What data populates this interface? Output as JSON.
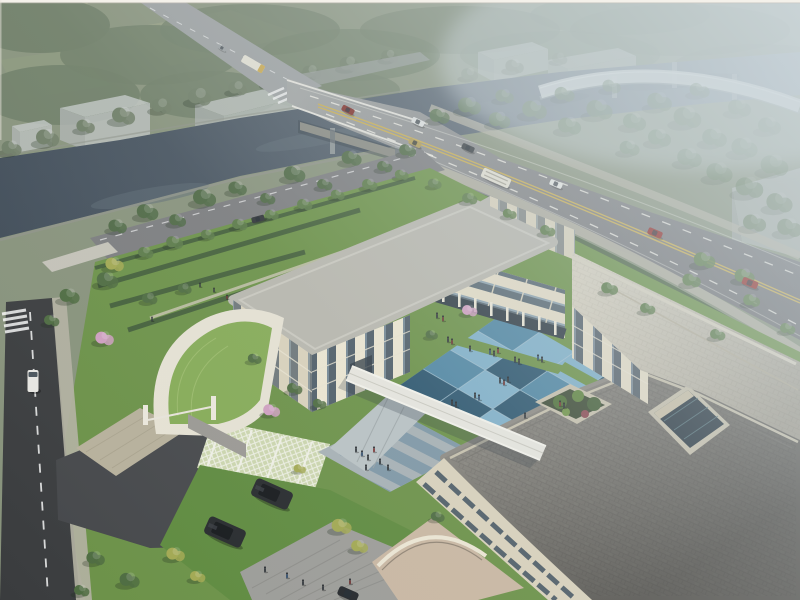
{
  "image": {
    "kind": "architectural aerial rendering",
    "subject": "Aerial view of a three-storey cream building complex with a blue checkered courtyard, entrance gatehouse with green roof, grass-grid parking, riverside arterial road with bridge and a curved highway overpass in haze",
    "no_text_visible": true
  },
  "inventory": {
    "buildings": [
      "west-wing",
      "north-range",
      "east-wing",
      "south-building",
      "gatehouse",
      "warehouses-distant"
    ],
    "vehicles": {
      "road_cars": 8,
      "buses": 2,
      "parked_suvs": 2,
      "white_van": 1,
      "local_road_car": 1,
      "bottom_edge_car": 1
    },
    "people_approx": 38,
    "blossom_trees": 3,
    "courtyard_tiles": "checkered blue plaza 4x4",
    "water": "canal river crossing under road bridge and overpass"
  },
  "colors": {
    "fog": "#ccd5d8",
    "forest_far": "#6e7d66",
    "forest_near": "#55704a",
    "tree_green": "#5b7a48",
    "tree_dark": "#46613c",
    "tree_yellow": "#a2a851",
    "blossom": "#cf9fc0",
    "hedge": "#3f5a38",
    "lawn": "#6b9147",
    "lawn_dark": "#5e8a3e",
    "grass_roof": "#85ab56",
    "river": "#46525e",
    "bank_wall": "#8e9288",
    "road_far": "#9b9fa0",
    "road_dark": "#3a3c3e",
    "asphalt_drive": "#45474a",
    "lane_white": "#eceae2",
    "lane_yellow": "#c9ad4e",
    "sidewalk": "#b4b1a2",
    "bridge_girder": "#cfc8b2",
    "overpass": "#d3d8d5",
    "wall_lit": "#ece6d2",
    "wall_shaded": "#d9d2bc",
    "wall_warm": "#e3dcc6",
    "roof_light": "#b8b7ae",
    "roof_tile": "#8d8a83",
    "parapet": "#c6c0ac",
    "glass_dark": "#3e4e5c",
    "glass_atrium": "#2c3a44",
    "court_light": "#7fb0c9",
    "court_mid": "#4f86a3",
    "court_dark": "#2b556e",
    "court_joint": "#a5c2d1",
    "walkway": "#e7e6df",
    "stripe_blue": "#7e97a6",
    "stripe_gray": "#a7b1b5",
    "plaza": "#9c9c98",
    "terrace": "#c9b7a2",
    "paver_lattice": "#ccd6ae",
    "suv": "#26292c",
    "car_red": "#8e2420",
    "car_white": "#e7e8e4",
    "car_gold": "#b09a52",
    "car_dark": "#33383c",
    "bus": "#e3e0d2",
    "van": "#e8e7e2",
    "people": "#2d3237",
    "warehouse": "#c3c8c6"
  }
}
